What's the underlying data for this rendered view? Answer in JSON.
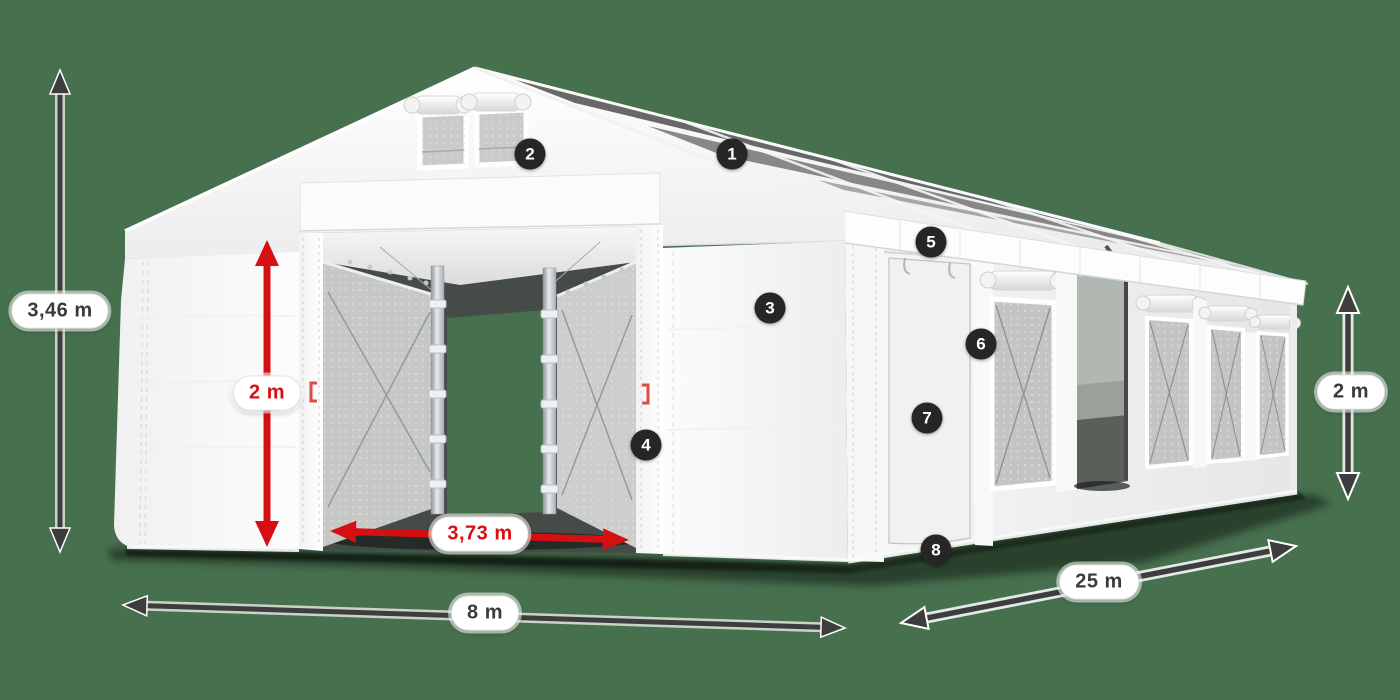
{
  "scene": {
    "background_color": "#47704E",
    "subject": "white-storage-tent-diagram"
  },
  "colors": {
    "dimension_dark": "#3D3D3D",
    "dimension_red": "#D60F12",
    "badge_background": "#262626",
    "badge_text": "#FFFFFF",
    "tent_white": "#F7F7F7"
  },
  "dimensions": [
    {
      "id": "total-height",
      "label": "3,46 m",
      "color": "dark",
      "orientation": "vertical",
      "position": "left"
    },
    {
      "id": "entrance-height",
      "label": "2 m",
      "color": "red",
      "orientation": "vertical",
      "position": "front-entrance"
    },
    {
      "id": "entrance-width",
      "label": "3,73 m",
      "color": "red",
      "orientation": "horizontal",
      "position": "front-entrance"
    },
    {
      "id": "tent-width",
      "label": "8 m",
      "color": "dark",
      "orientation": "horizontal",
      "position": "bottom-front"
    },
    {
      "id": "tent-length",
      "label": "25 m",
      "color": "dark",
      "orientation": "diagonal",
      "position": "bottom-right"
    },
    {
      "id": "side-height",
      "label": "2 m",
      "color": "dark",
      "orientation": "vertical",
      "position": "right"
    }
  ],
  "markers": [
    {
      "label": "1"
    },
    {
      "label": "2"
    },
    {
      "label": "3"
    },
    {
      "label": "4"
    },
    {
      "label": "5"
    },
    {
      "label": "6"
    },
    {
      "label": "7"
    },
    {
      "label": "8"
    }
  ]
}
